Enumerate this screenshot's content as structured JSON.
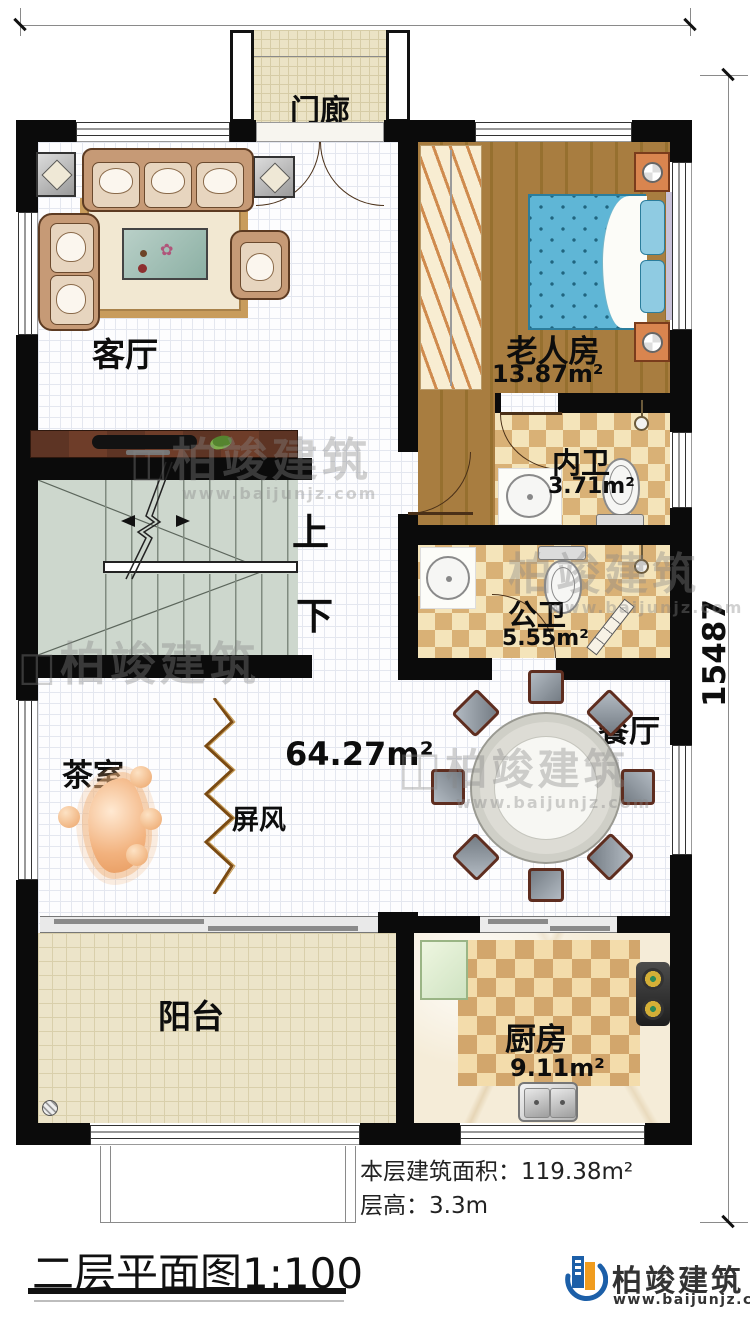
{
  "dimensions": {
    "width": "9000",
    "height": "15487"
  },
  "rooms": {
    "porch": {
      "label": "门廊"
    },
    "living": {
      "label": "客厅"
    },
    "bedroom": {
      "label": "老人房",
      "area": "13.87m²"
    },
    "bath_inner": {
      "label": "内卫",
      "area": "3.71m²"
    },
    "bath_public": {
      "label": "公卫",
      "area": "5.55m²"
    },
    "hall": {
      "area": "64.27m²"
    },
    "dining": {
      "label": "餐厅"
    },
    "tea": {
      "label": "茶室"
    },
    "screen": {
      "label": "屏风"
    },
    "stairs": {
      "up": "上",
      "down": "下"
    },
    "balcony": {
      "label": "阳台"
    },
    "kitchen": {
      "label": "厨房",
      "area": "9.11m²"
    }
  },
  "footer": {
    "floor_area": "本层建筑面积：119.38m²",
    "floor_height": "层高：3.3m",
    "title": "二层平面图1:100"
  },
  "brand": {
    "name": "柏竣建筑",
    "url": "www.baijunjz.com"
  },
  "colors": {
    "wall": "#0b0b0b",
    "bed": "#5fb6d6",
    "brand_blue": "#1c5fa8",
    "brand_orange": "#f09c1e"
  }
}
